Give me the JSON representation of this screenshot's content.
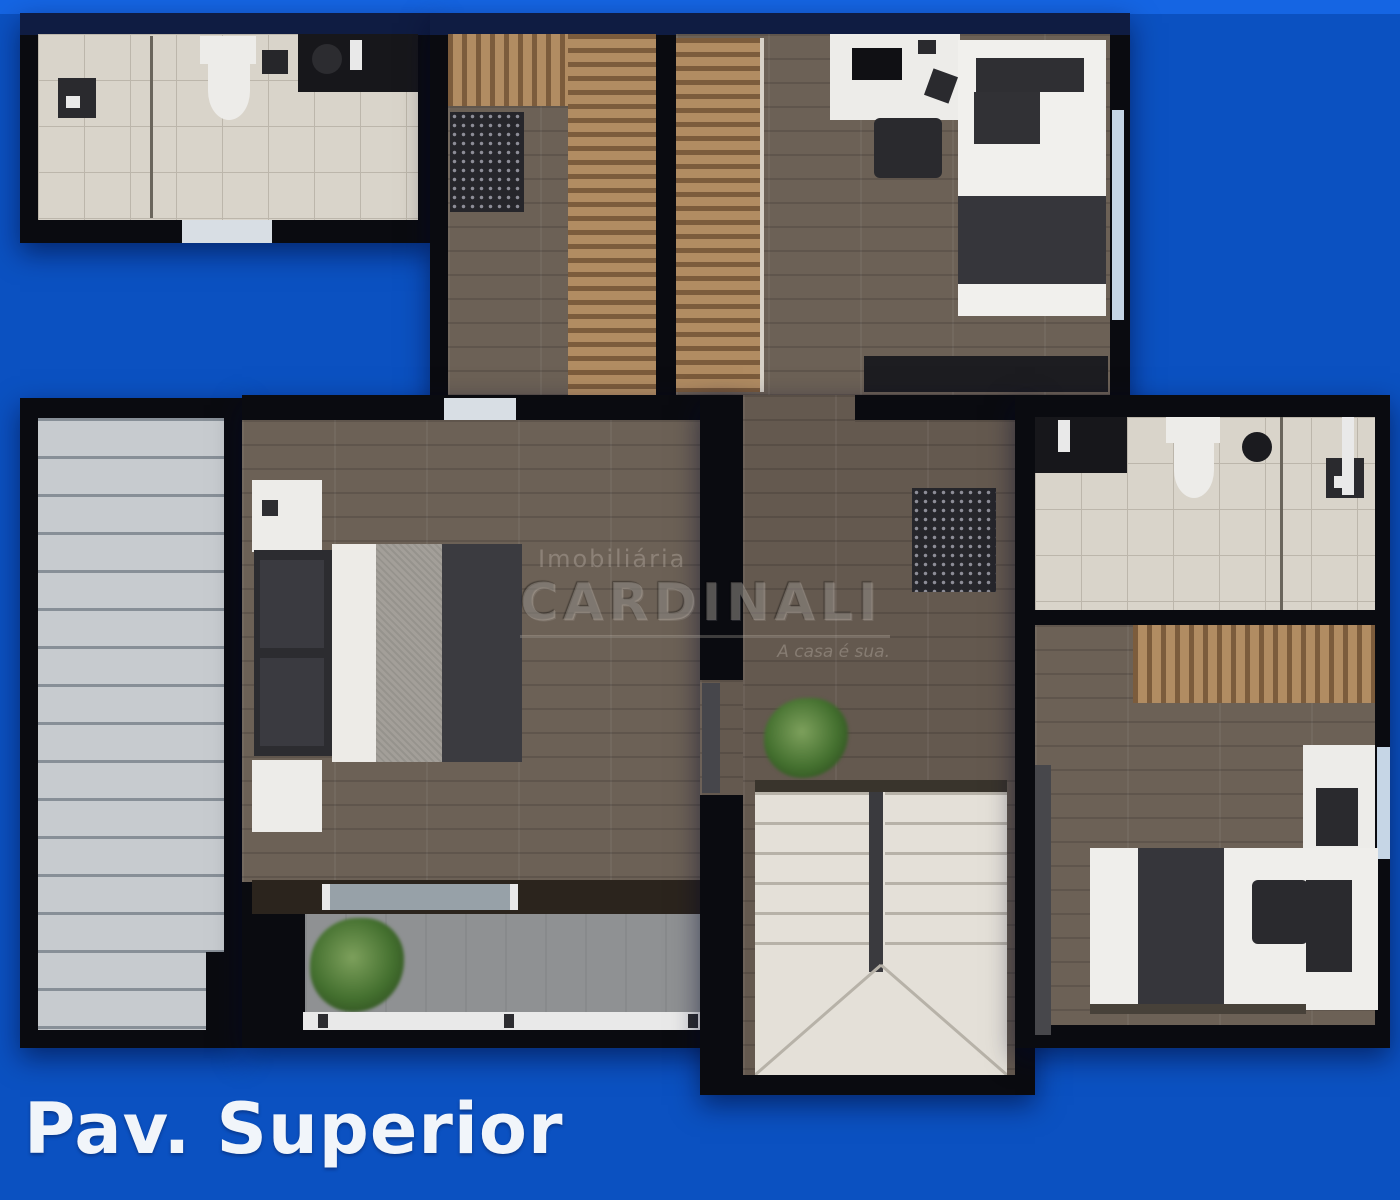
{
  "header": {
    "floor_label": "Pav. Superior"
  },
  "watermark": {
    "line_small": "Imobiliária",
    "line_large": "CARDINALI",
    "tagline": "A casa é sua."
  },
  "colors": {
    "background": "#0B51C1",
    "background_top": "#1565E3",
    "wall": "#0A0B10",
    "wood": "#6C6156",
    "wood_dark": "#64594F",
    "wardrobe_light": "#B18C62",
    "wardrobe_dark": "#7C5C3C",
    "tile": "#D9D4CA",
    "tile_line": "#BCB6AB",
    "roof": "#C7CBCF",
    "roof_line": "#878F97",
    "stairs": "#E4E0D8",
    "stairs_line": "#B7B2A8",
    "concrete": "#8F9193",
    "plant": "#44702F",
    "railing": "#E9E9E9",
    "furniture_white": "#EDECE9",
    "furniture_dark": "#2A2A2E",
    "bedding_dark": "#36363B",
    "bedding_gray": "#A39F99",
    "window_glass": "#C6D6E6",
    "door_light": "#D8DEE4",
    "text": "#F1F5FA"
  }
}
